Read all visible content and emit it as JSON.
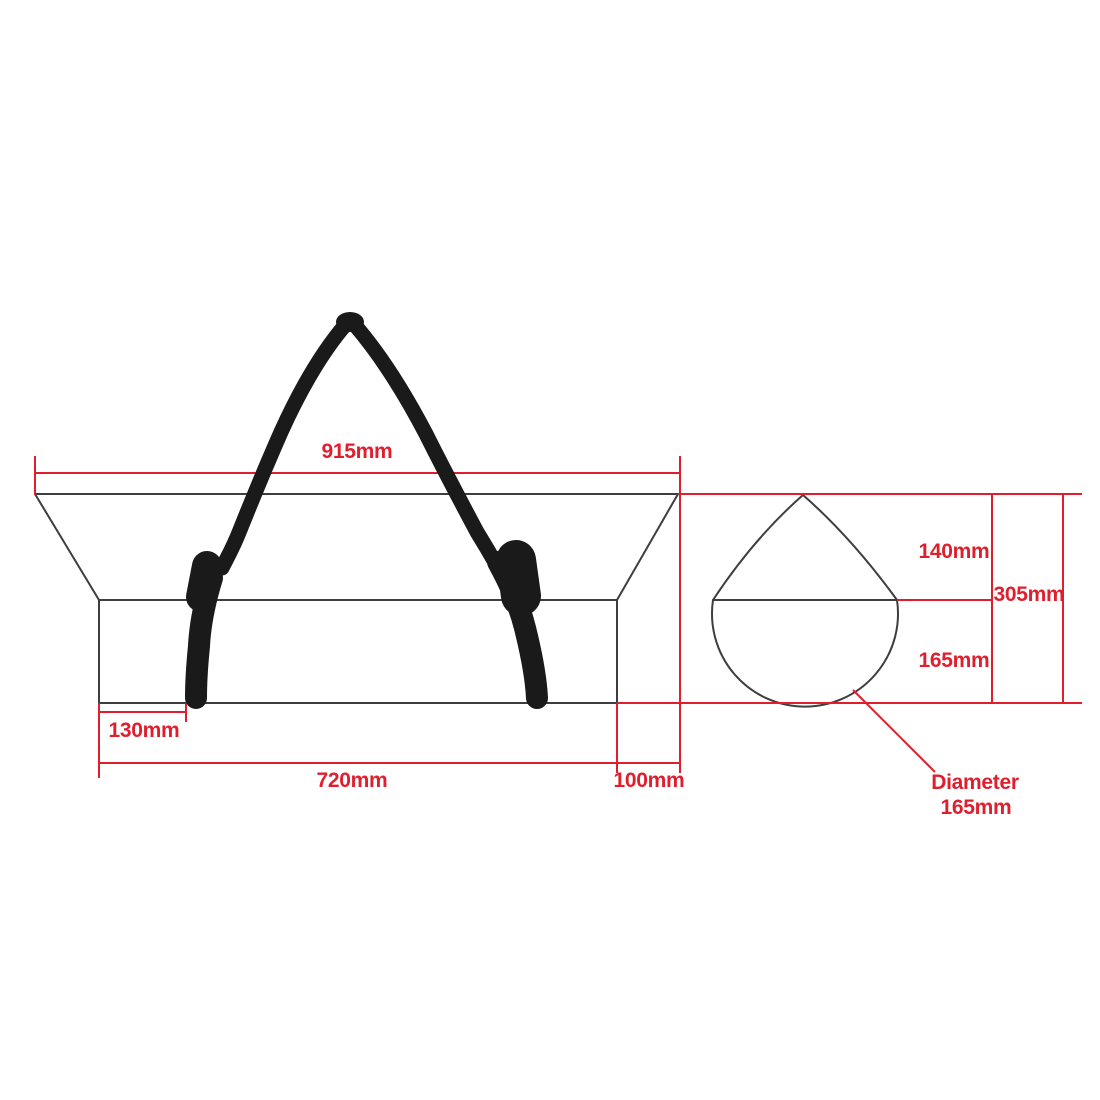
{
  "drawing": {
    "side_view": {
      "top_length": "915mm",
      "strap_inset": "130mm",
      "body_length": "720mm",
      "end_taper": "100mm"
    },
    "cross_section": {
      "cone_height": "140mm",
      "overall_height": "305mm",
      "lower_height": "165mm",
      "diameter_label": "Diameter",
      "diameter_value": "165mm"
    },
    "colors": {
      "dimension_red": "#e01f2e",
      "outline_gray": "#3e3e3e",
      "strap_black": "#1a1a1a",
      "background": "#ffffff"
    }
  }
}
